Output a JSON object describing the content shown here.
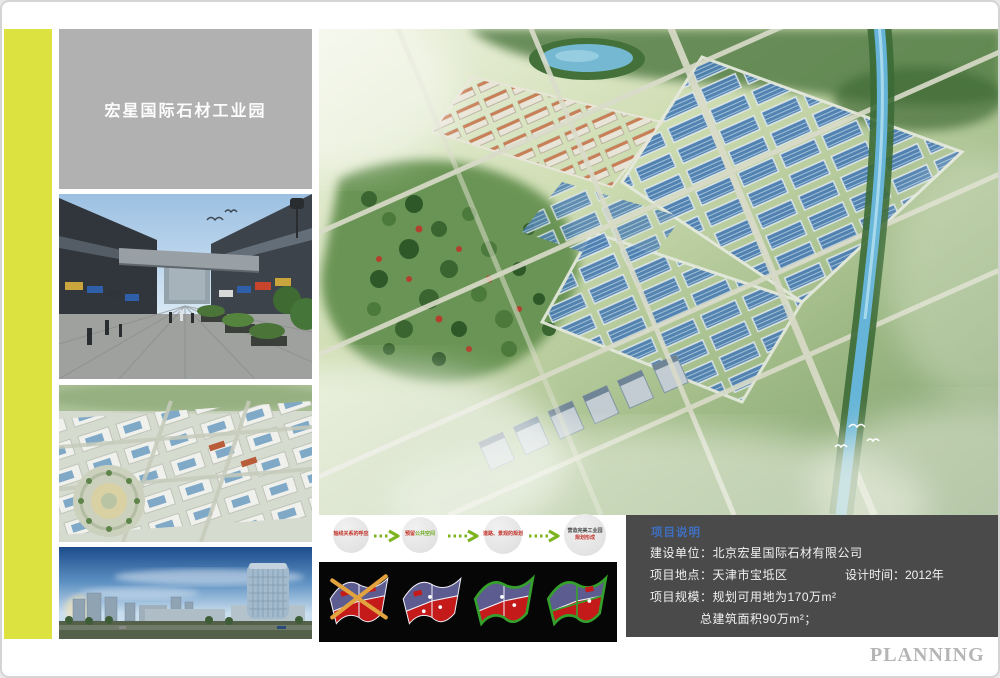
{
  "header": {
    "project_title": "宏星国际石材工业园"
  },
  "flow": {
    "steps": [
      {
        "text": "轴线关系的呼应"
      },
      {
        "text_red": "预留",
        "text_green": "公共空间"
      },
      {
        "text": "道路、景观的规划"
      },
      {
        "line1": "营造完美工业园",
        "line2": "规划形成"
      }
    ]
  },
  "info": {
    "title": "项目说明",
    "row1": "建设单位：北京宏星国际石材有限公司",
    "row2_left": "项目地点：天津市宝坻区",
    "row2_right": "设计时间：2012年",
    "row3": "项目规模：规划可用地为170万m²",
    "row4": "总建筑面积90万m²；"
  },
  "footer": {
    "watermark": "PLANNING"
  },
  "colors": {
    "accent_stripe": "#dce340",
    "title_box_bg": "#b1b1b1",
    "info_box_bg": "#4a4a4a",
    "info_title_blue": "#3f6fc0",
    "flow_green": "#7db41e",
    "flow_red": "#c4342a"
  }
}
